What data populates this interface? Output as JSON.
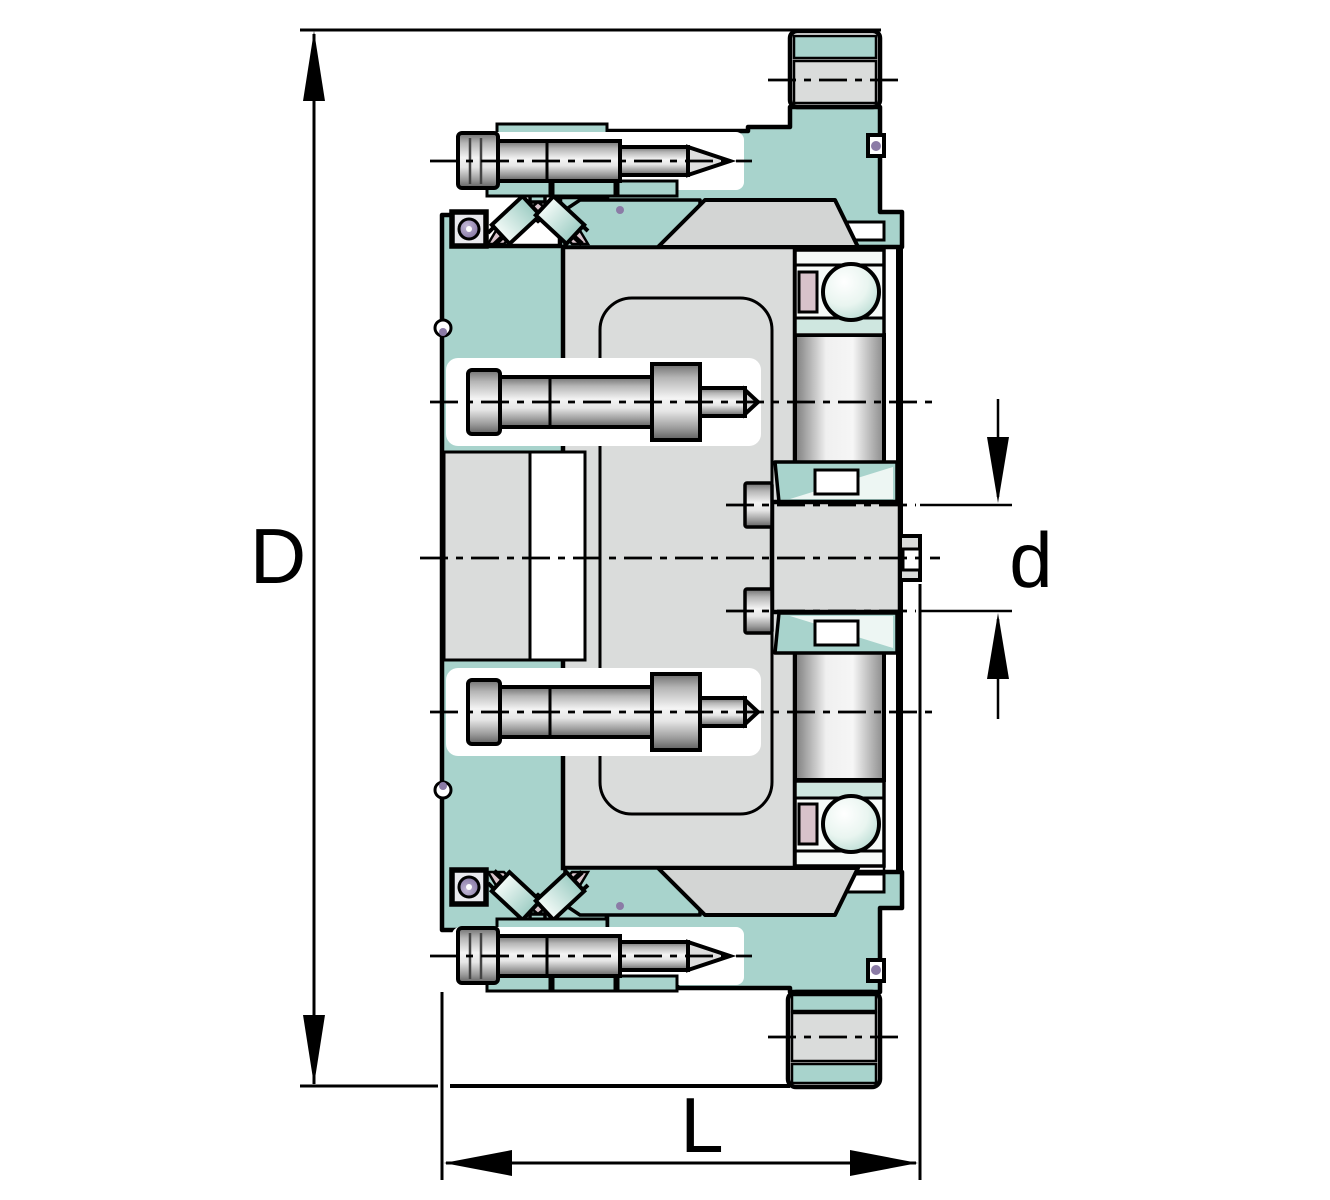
{
  "diagram": {
    "kind": "technical cross-section drawing",
    "labels": {
      "outer_diameter": "D",
      "shaft_diameter": "d",
      "overall_length": "L"
    },
    "colors": {
      "background": "#ffffff",
      "outline": "#000000",
      "housing_teal": "#a8d3cc",
      "race_teal_light": "#cfe7e0",
      "highlight_teal": "#edf6f3",
      "part_gray": "#dadcdb",
      "cone_gray": "#d3d5d4",
      "cage_pink": "#d8c2ca",
      "seal_purple": "#8b7ba6",
      "metal_light": "#f2f2f2",
      "metal_dark": "#5f5f5f"
    }
  }
}
